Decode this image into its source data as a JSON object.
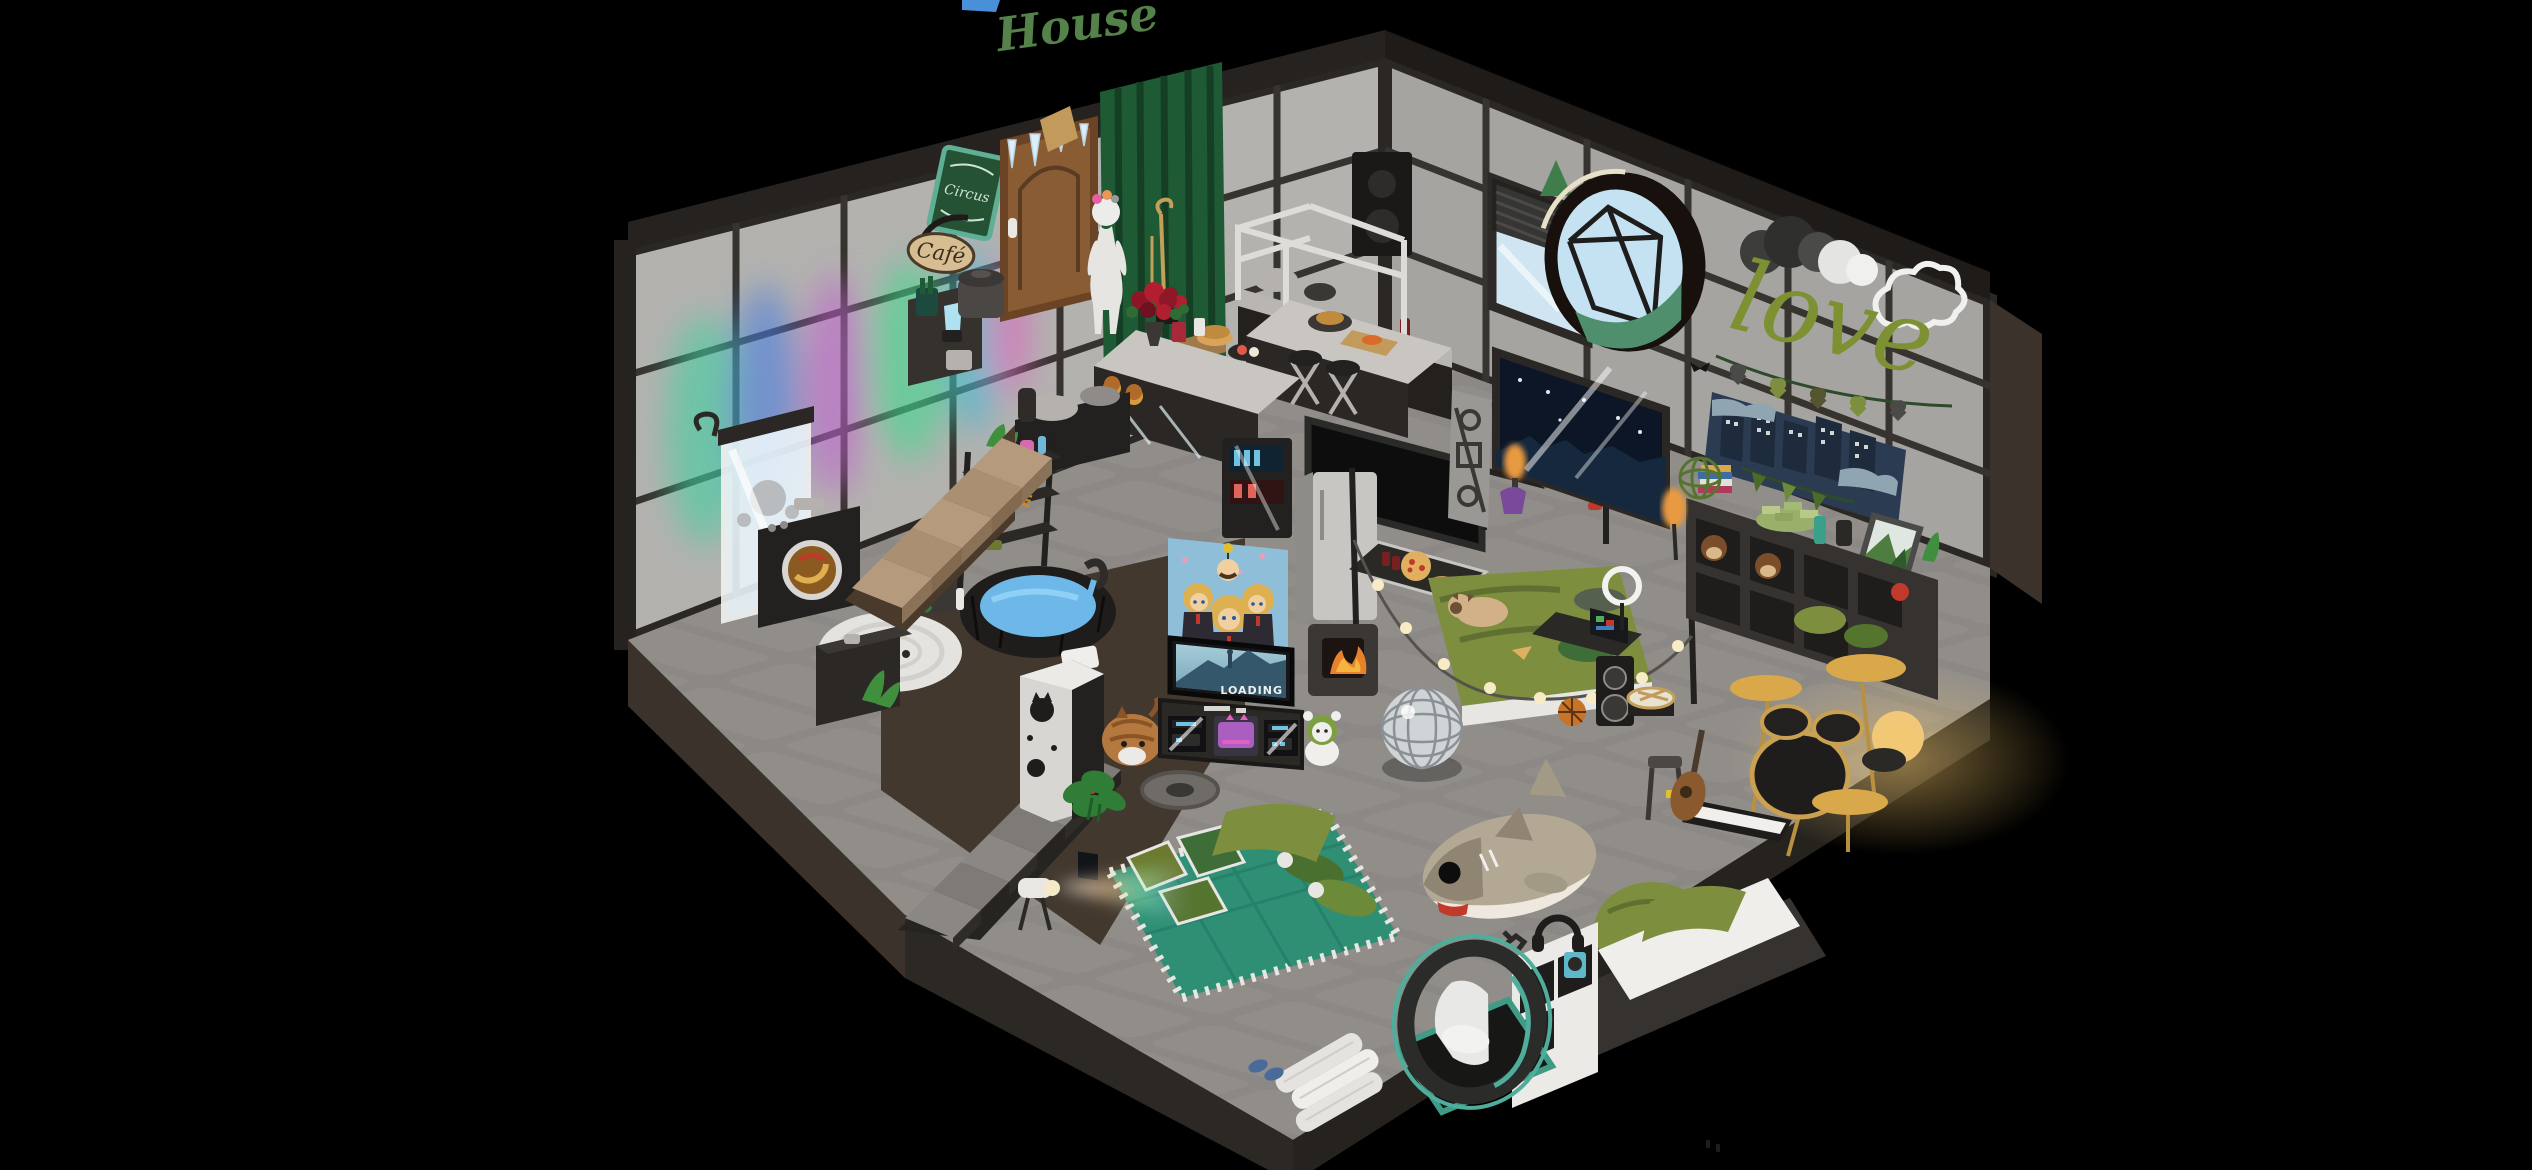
{
  "app": {
    "title": "House",
    "title_color": "#55814a"
  },
  "signs": {
    "cafe_sign": "Café",
    "chalkboard_sign": "Circus",
    "neon_love": "love",
    "shelf_love": "LOVE",
    "tv_screen_status": "LOADING"
  },
  "palette": {
    "background": "#000000",
    "wall_panel": "#b3b2af",
    "wall_frame": "#2b2724",
    "floor_stone": "#8b8885",
    "foundation_brown": "#42382e",
    "stair_wood": "#a3876a",
    "accent_olive": "#7d8f3e",
    "rug_teal": "#2e8f74",
    "neon_green": "#7e9132",
    "water_blue": "#6db8e8",
    "fire_orange": "#e8822a",
    "night_window": "#0c1626",
    "amber_sign": "#c98a2e"
  },
  "objects": [
    "front-door",
    "green-curtain",
    "mannequin-avatar",
    "cafe-sign",
    "chalkboard-sign",
    "coat-stand",
    "rose-basket",
    "kitchen-island",
    "overhead-rack",
    "back-counter",
    "bar-stools",
    "bbq-grills",
    "drinks-fridge",
    "coffee-cart",
    "trash-can",
    "window-blinds",
    "porthole-window-nook",
    "night-window",
    "love-neon",
    "cloud-neon",
    "storm-cloud",
    "heart-garland",
    "skyline-tapestry",
    "bunting-garland",
    "landscape-painting",
    "cube-shelves",
    "monkey-plush",
    "money-stack",
    "book-stack",
    "floor-lamp",
    "paper-lantern",
    "drum-kit",
    "snare-drum",
    "keyboard-piano",
    "guitar",
    "stool",
    "basketball",
    "disco-ball",
    "desk-laptop",
    "floor-speaker",
    "ring-light",
    "bed",
    "pug-dog",
    "string-lights",
    "coffee-table",
    "wood-stove",
    "fridge",
    "cinema-screen",
    "wardrobe-rack",
    "banner-tapestry",
    "band-poster",
    "tv",
    "tv-stand",
    "game-console",
    "mascot-plush",
    "cat-plush",
    "arcade-cabinet",
    "monstera-plant",
    "manhole-decal",
    "upper-stairs",
    "lower-stairs",
    "ladder-shelf",
    "hot-tub",
    "shower",
    "washing-machine",
    "round-face-rug",
    "sink-cabinet",
    "laundry-basket",
    "teal-rug",
    "floor-pillows",
    "green-blanket",
    "projector-light",
    "towel-stack",
    "slippers",
    "shark-plush",
    "bean-bag",
    "daybed-shelf",
    "pod-chair",
    "floor-mat",
    "headphones"
  ]
}
